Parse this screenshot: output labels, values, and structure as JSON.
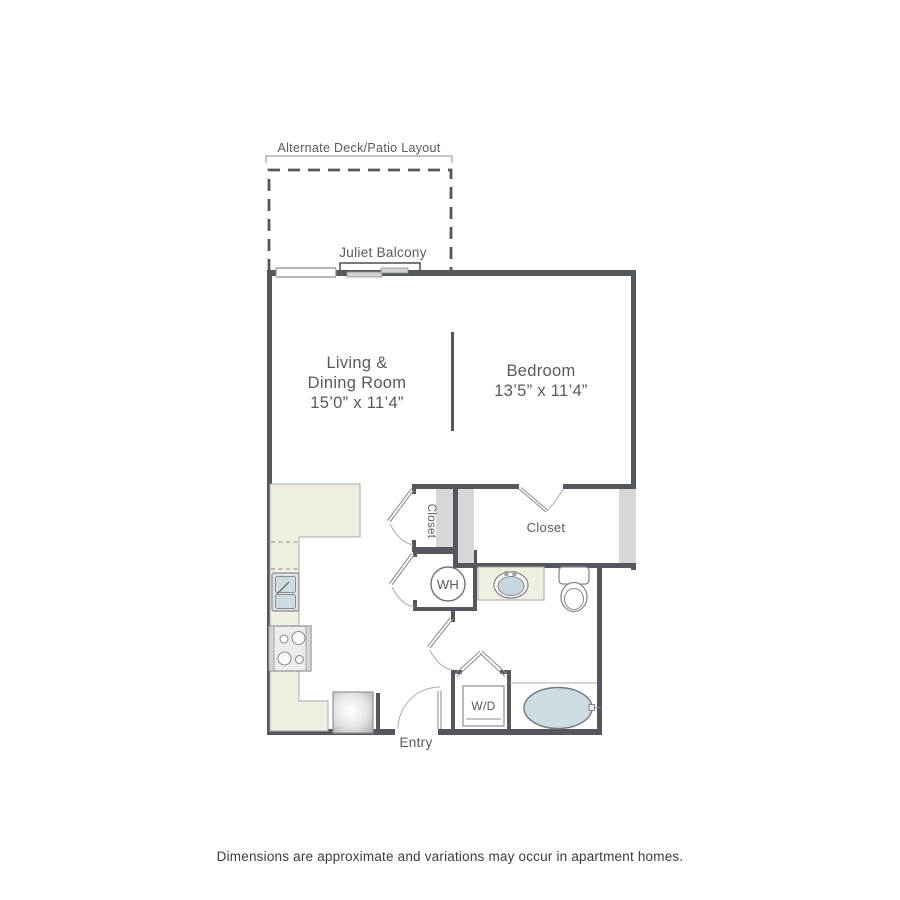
{
  "page": {
    "disclaimer": "Dimensions are approximate and variations may occur in apartment homes."
  },
  "floorplan": {
    "annotations": {
      "alternate_layout_label": "Alternate Deck/Patio Layout",
      "juliet_balcony_label": "Juliet Balcony",
      "entry_label": "Entry"
    },
    "rooms": {
      "living_dining": {
        "line1": "Living &",
        "line2": "Dining Room",
        "dims": "15’0” x 11’4”"
      },
      "bedroom": {
        "name": "Bedroom",
        "dims": "13’5” x 11’4”"
      },
      "small_closet": {
        "name": "Closet"
      },
      "bedroom_closet": {
        "name": "Closet"
      }
    },
    "fixtures": {
      "water_heater_label": "WH",
      "washer_dryer_label": "W/D"
    },
    "colors": {
      "wall": "#54585e",
      "counter_fill": "#f0efe1",
      "shelf_fill": "#d7d7d9",
      "water_fill": "#cddce1",
      "line": "#8b8e91",
      "label": "#58595c"
    }
  }
}
